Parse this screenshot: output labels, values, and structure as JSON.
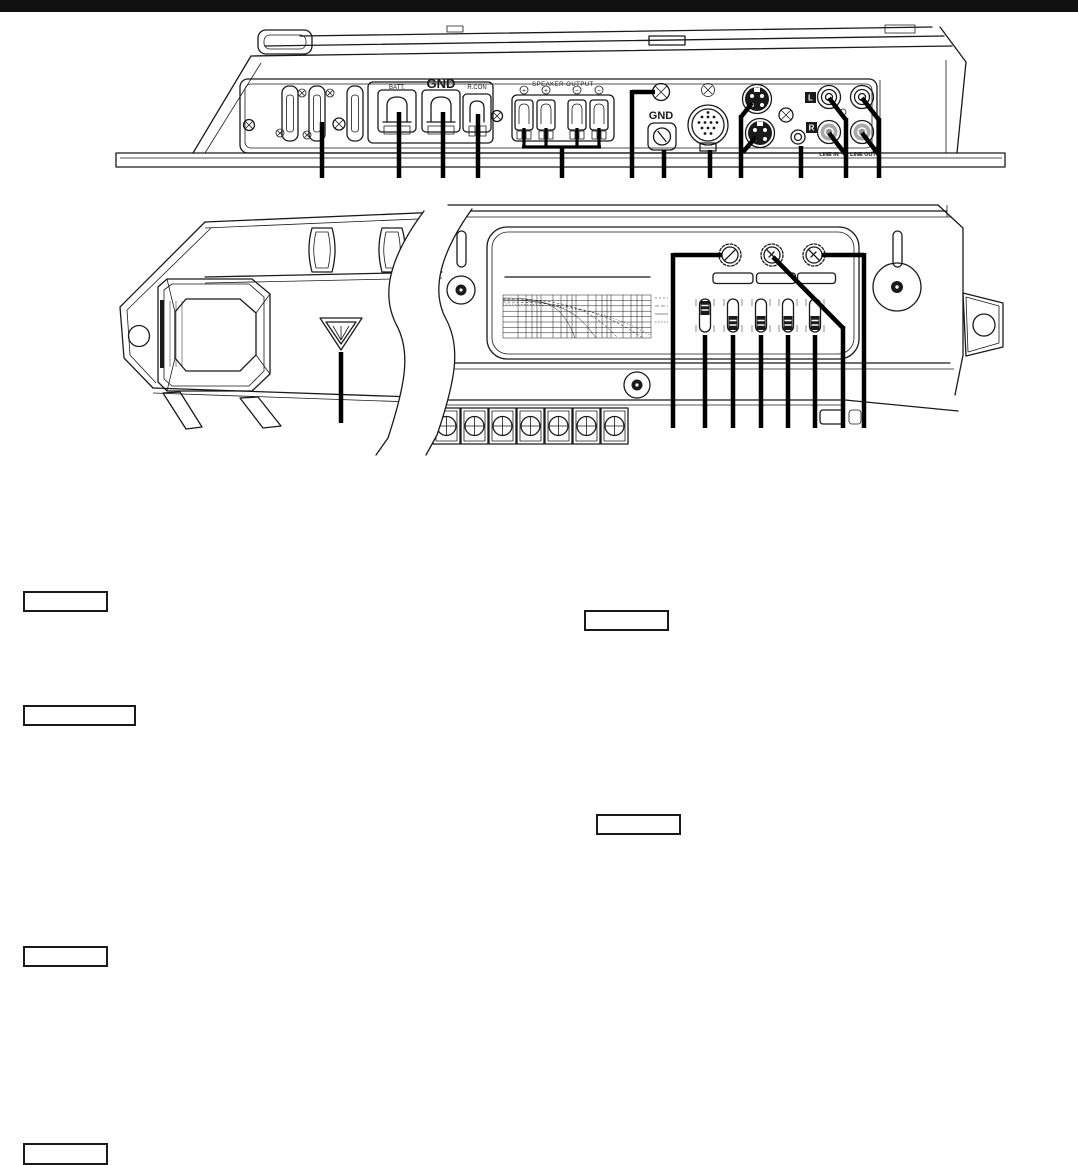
{
  "page": {
    "background": "#ffffff",
    "ink": "#1a1a1a",
    "topbar_color": "#111111",
    "shade_gray": "#a8a8a8"
  },
  "figure_top": {
    "labels": {
      "batt": "BATT.",
      "gnd_terminal": "GND",
      "rcon": "R.CON",
      "speaker_output": "SPEAKER OUTPUT",
      "gnd_screw": "GND",
      "line_in": "LINE IN",
      "line_out": "LINE OUT",
      "left_channel": "L",
      "right_channel": "R"
    },
    "polarity": [
      "+",
      "+",
      "−",
      "−"
    ]
  },
  "callouts": {
    "labels": [
      "",
      "",
      "",
      "",
      "",
      ""
    ]
  }
}
